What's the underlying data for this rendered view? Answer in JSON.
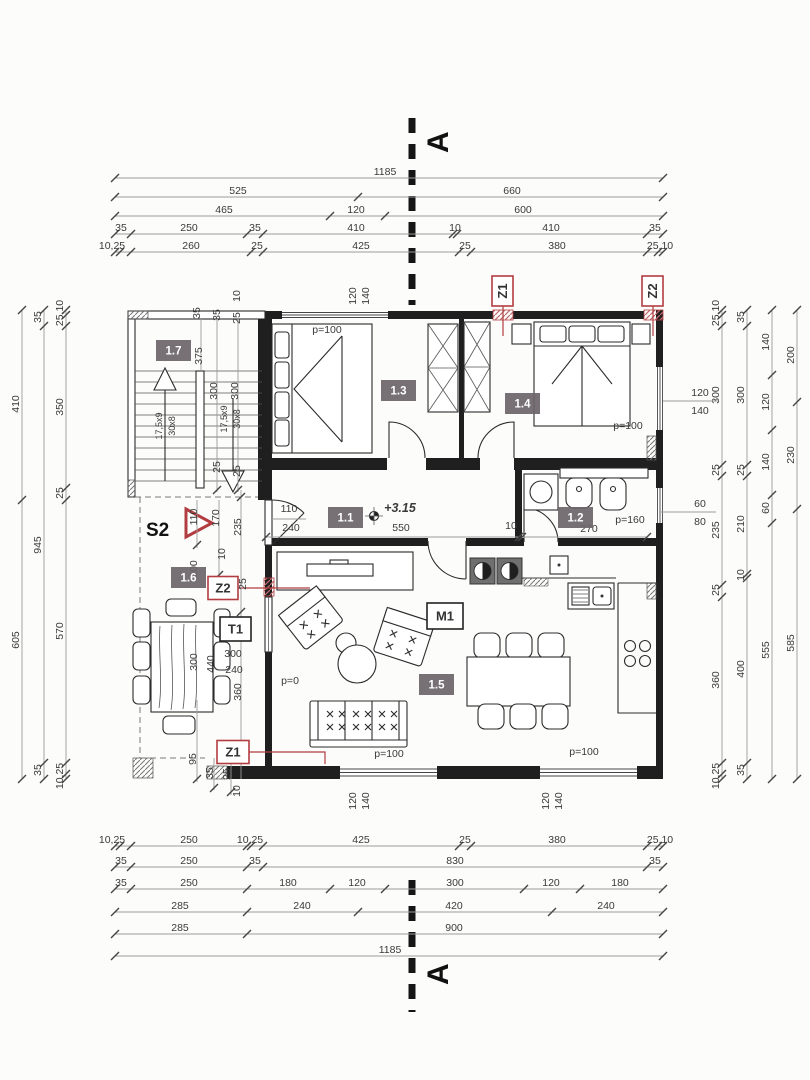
{
  "section": {
    "letter": "A"
  },
  "dims": {
    "h": [
      {
        "y": 178,
        "x1": 115,
        "x2": 663,
        "t": [
          115,
          663
        ],
        "l": [
          [
            "1185",
            385
          ]
        ]
      },
      {
        "y": 197,
        "x1": 115,
        "x2": 663,
        "t": [
          115,
          358,
          663
        ],
        "l": [
          [
            "525",
            238
          ],
          [
            "660",
            512
          ]
        ]
      },
      {
        "y": 216,
        "x1": 115,
        "x2": 663,
        "t": [
          115,
          330,
          385,
          663
        ],
        "l": [
          [
            "465",
            224
          ],
          [
            "120",
            356
          ],
          [
            "600",
            523
          ]
        ]
      },
      {
        "y": 234,
        "x1": 115,
        "x2": 663,
        "t": [
          115,
          131,
          247,
          263,
          453,
          457,
          647,
          663
        ],
        "l": [
          [
            "35",
            121
          ],
          [
            "250",
            189
          ],
          [
            "35",
            255
          ],
          [
            "410",
            356
          ],
          [
            "10",
            455
          ],
          [
            "410",
            551
          ],
          [
            "35",
            655
          ]
        ]
      },
      {
        "y": 252,
        "x1": 115,
        "x2": 663,
        "t": [
          115,
          120,
          131,
          251,
          263,
          459,
          471,
          647,
          658,
          663
        ],
        "l": [
          [
            "10,25",
            112
          ],
          [
            "260",
            191
          ],
          [
            "25",
            257
          ],
          [
            "425",
            361
          ],
          [
            "25",
            465
          ],
          [
            "380",
            557
          ],
          [
            "25,10",
            660
          ]
        ]
      },
      {
        "y": 846,
        "x1": 115,
        "x2": 663,
        "t": [
          115,
          120,
          131,
          247,
          251,
          263,
          459,
          471,
          647,
          658,
          663
        ],
        "l": [
          [
            "10,25",
            112
          ],
          [
            "250",
            189
          ],
          [
            "10,25",
            250
          ],
          [
            "425",
            361
          ],
          [
            "25",
            465
          ],
          [
            "380",
            557
          ],
          [
            "25,10",
            660
          ]
        ]
      },
      {
        "y": 867,
        "x1": 115,
        "x2": 663,
        "t": [
          115,
          131,
          247,
          263,
          647,
          663
        ],
        "l": [
          [
            "35",
            121
          ],
          [
            "250",
            189
          ],
          [
            "35",
            255
          ],
          [
            "830",
            455
          ],
          [
            "35",
            655
          ]
        ]
      },
      {
        "y": 889,
        "x1": 115,
        "x2": 663,
        "t": [
          115,
          131,
          247,
          330,
          385,
          524,
          580,
          663
        ],
        "l": [
          [
            "35",
            121
          ],
          [
            "250",
            189
          ],
          [
            "180",
            288
          ],
          [
            "120",
            357
          ],
          [
            "300",
            455
          ],
          [
            "120",
            551
          ],
          [
            "180",
            620
          ]
        ]
      },
      {
        "y": 912,
        "x1": 115,
        "x2": 663,
        "t": [
          115,
          247,
          358,
          552,
          663
        ],
        "l": [
          [
            "285",
            180
          ],
          [
            "240",
            302
          ],
          [
            "420",
            454
          ],
          [
            "240",
            606
          ]
        ]
      },
      {
        "y": 934,
        "x1": 115,
        "x2": 663,
        "t": [
          115,
          247,
          663
        ],
        "l": [
          [
            "285",
            180
          ],
          [
            "900",
            454
          ]
        ]
      },
      {
        "y": 956,
        "x1": 115,
        "x2": 663,
        "t": [
          115,
          663
        ],
        "l": [
          [
            "1185",
            390
          ]
        ]
      }
    ],
    "v": [
      {
        "x": 22,
        "y1": 310,
        "y2": 779,
        "t": [
          310,
          500,
          779
        ],
        "l": [
          [
            "410",
            404
          ],
          [
            "605",
            640
          ]
        ]
      },
      {
        "x": 44,
        "y1": 310,
        "y2": 779,
        "t": [
          310,
          326,
          763,
          779
        ],
        "l": [
          [
            "35",
            317
          ],
          [
            "945",
            545
          ],
          [
            "35",
            770
          ]
        ]
      },
      {
        "x": 66,
        "y1": 310,
        "y2": 779,
        "t": [
          310,
          315,
          326,
          488,
          500,
          763,
          774,
          779
        ],
        "l": [
          [
            "25,10",
            313
          ],
          [
            "350",
            407
          ],
          [
            "25",
            493
          ],
          [
            "570",
            631
          ],
          [
            "10,25",
            776
          ]
        ]
      },
      {
        "x": 722,
        "y1": 310,
        "y2": 779,
        "t": [
          310,
          315,
          326,
          465,
          476,
          585,
          597,
          763,
          774,
          779
        ],
        "l": [
          [
            "25,10",
            313
          ],
          [
            "300",
            395
          ],
          [
            "25",
            470
          ],
          [
            "235",
            530
          ],
          [
            "25",
            590
          ],
          [
            "360",
            680
          ],
          [
            "10,25",
            776
          ]
        ]
      },
      {
        "x": 747,
        "y1": 310,
        "y2": 779,
        "t": [
          310,
          326,
          465,
          476,
          574,
          578,
          763,
          779
        ],
        "l": [
          [
            "35",
            317
          ],
          [
            "300",
            395
          ],
          [
            "25",
            470
          ],
          [
            "210",
            524
          ],
          [
            "10",
            575
          ],
          [
            "400",
            669
          ],
          [
            "35",
            770
          ]
        ]
      },
      {
        "x": 772,
        "y1": 310,
        "y2": 779,
        "t": [
          310,
          375,
          430,
          495,
          523,
          779
        ],
        "l": [
          [
            "140",
            342
          ],
          [
            "120",
            402
          ],
          [
            "140",
            462
          ],
          [
            "60",
            508
          ],
          [
            "555",
            650
          ]
        ]
      },
      {
        "x": 797,
        "y1": 310,
        "y2": 779,
        "t": [
          310,
          402,
          509,
          779
        ],
        "l": [
          [
            "200",
            355
          ],
          [
            "230",
            455
          ],
          [
            "585",
            643
          ]
        ]
      }
    ],
    "extra_lines": [
      [
        266,
        537,
        519,
        537
      ],
      [
        522,
        537,
        647,
        537
      ],
      [
        197,
        500,
        197,
        548
      ],
      [
        219,
        500,
        219,
        578
      ],
      [
        241,
        490,
        241,
        779
      ],
      [
        217,
        319,
        217,
        492
      ],
      [
        238,
        319,
        238,
        492
      ],
      [
        201,
        319,
        201,
        371
      ],
      [
        197,
        700,
        197,
        782
      ],
      [
        214,
        758,
        214,
        790
      ],
      [
        231,
        758,
        231,
        795
      ],
      [
        272,
        519,
        306,
        519
      ],
      [
        663,
        401,
        718,
        401
      ],
      [
        660,
        512,
        716,
        512
      ]
    ],
    "slashes": [
      [
        266,
        537
      ],
      [
        519,
        537
      ],
      [
        522,
        537
      ],
      [
        647,
        537
      ],
      [
        241,
        497
      ],
      [
        241,
        612
      ],
      [
        217,
        490
      ],
      [
        238,
        490
      ],
      [
        197,
        545
      ],
      [
        219,
        575
      ],
      [
        197,
        779
      ],
      [
        214,
        788
      ],
      [
        231,
        792
      ]
    ]
  },
  "free_labels": [
    [
      "10",
      240,
      296,
      -90,
      ""
    ],
    [
      "35",
      200,
      313,
      -90,
      ""
    ],
    [
      "35",
      220,
      315,
      -90,
      ""
    ],
    [
      "25",
      240,
      318,
      -90,
      ""
    ],
    [
      "375",
      202,
      356,
      -90,
      ""
    ],
    [
      "300",
      217,
      391,
      -90,
      ""
    ],
    [
      "300",
      238,
      391,
      -90,
      ""
    ],
    [
      "17,5x9",
      162,
      426,
      -90,
      "sm"
    ],
    [
      "30x8",
      175,
      426,
      -90,
      "sm"
    ],
    [
      "17,5x9",
      227,
      419,
      -90,
      "sm"
    ],
    [
      "30x8",
      240,
      419,
      -90,
      "sm"
    ],
    [
      "25",
      220,
      467,
      -90,
      ""
    ],
    [
      "25",
      240,
      471,
      -90,
      ""
    ],
    [
      "110",
      197,
      517,
      -90,
      ""
    ],
    [
      "170",
      219,
      518,
      -90,
      ""
    ],
    [
      "235",
      241,
      527,
      -90,
      ""
    ],
    [
      "10",
      225,
      554,
      -90,
      ""
    ],
    [
      "100",
      197,
      569,
      -90,
      ""
    ],
    [
      "25",
      246,
      584,
      -90,
      ""
    ],
    [
      "300",
      197,
      662,
      -90,
      ""
    ],
    [
      "440",
      214,
      664,
      -90,
      ""
    ],
    [
      "300",
      233,
      657,
      0,
      ""
    ],
    [
      "240",
      234,
      673,
      0,
      ""
    ],
    [
      "360",
      241,
      692,
      -90,
      ""
    ],
    [
      "95",
      196,
      759,
      -90,
      ""
    ],
    [
      "35",
      213,
      773,
      -90,
      ""
    ],
    [
      "25",
      230,
      774,
      -90,
      ""
    ],
    [
      "10",
      240,
      791,
      -90,
      ""
    ],
    [
      "120",
      356,
      296,
      -90,
      ""
    ],
    [
      "140",
      369,
      296,
      -90,
      ""
    ],
    [
      "120",
      356,
      801,
      -90,
      ""
    ],
    [
      "140",
      369,
      801,
      -90,
      ""
    ],
    [
      "120",
      549,
      801,
      -90,
      ""
    ],
    [
      "140",
      562,
      801,
      -90,
      ""
    ],
    [
      "p=100",
      327,
      333,
      0,
      ""
    ],
    [
      "p=100",
      628,
      429,
      0,
      ""
    ],
    [
      "p=100",
      389,
      757,
      0,
      ""
    ],
    [
      "p=100",
      584,
      755,
      0,
      ""
    ],
    [
      "p=160",
      630,
      523,
      0,
      ""
    ],
    [
      "p=0",
      290,
      684,
      0,
      ""
    ],
    [
      "550",
      401,
      531,
      0,
      ""
    ],
    [
      "270",
      589,
      532,
      0,
      ""
    ],
    [
      "10",
      511,
      529,
      0,
      ""
    ],
    [
      "110",
      289,
      512,
      0,
      ""
    ],
    [
      "240",
      291,
      531,
      0,
      ""
    ],
    [
      "120",
      700,
      396,
      0,
      ""
    ],
    [
      "140",
      700,
      414,
      0,
      ""
    ],
    [
      "60",
      700,
      507,
      0,
      ""
    ],
    [
      "80",
      700,
      525,
      0,
      ""
    ],
    [
      "+3.15",
      400,
      512,
      0,
      "lvl"
    ]
  ],
  "rooms": [
    [
      "1.7",
      173.5,
      350.5
    ],
    [
      "1.3",
      398.5,
      390.5
    ],
    [
      "1.4",
      522.5,
      403.5
    ],
    [
      "1.1",
      345.5,
      517.5
    ],
    [
      "1.2",
      575.5,
      517.5
    ],
    [
      "1.6",
      188.5,
      577.5
    ],
    [
      "1.5",
      436.5,
      684.5
    ]
  ],
  "markers": {
    "boxes": [
      [
        "Z1",
        502.5,
        291,
        21,
        30,
        1,
        "R"
      ],
      [
        "Z2",
        652.5,
        291,
        21,
        30,
        1,
        "R"
      ],
      [
        "Z2",
        223,
        588,
        30,
        23,
        0,
        "R"
      ],
      [
        "Z1",
        233,
        752,
        32,
        23,
        0,
        "R"
      ],
      [
        "T1",
        235.5,
        629,
        31,
        24,
        0,
        "K"
      ],
      [
        "M1",
        445,
        616,
        36,
        26,
        0,
        "K"
      ]
    ],
    "s2": {
      "label": "S2"
    }
  },
  "colors": {
    "marker_red": "#b23d41",
    "room_box": "#6b6468",
    "wall": "#1f1f1f"
  }
}
